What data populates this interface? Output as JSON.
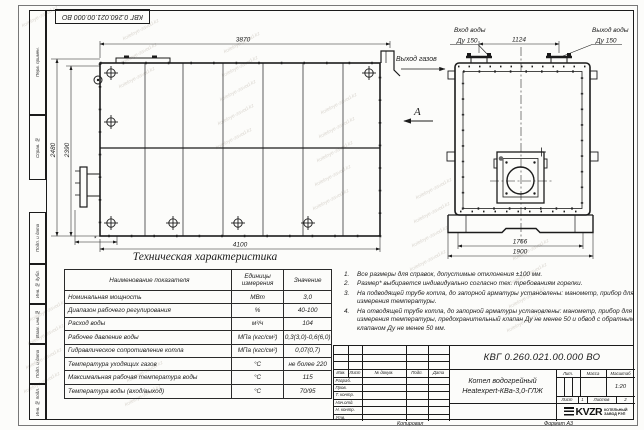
{
  "page": {
    "watermark": "kotelnye-zavod.kz",
    "copied_label": "Копировал",
    "format_label": "Формат А3",
    "doc_number_top": "КВГ 0.260.021.00.000 ВО"
  },
  "frame_columns": [
    "Перв. примен.",
    "Справ. №",
    "Подп. и дата",
    "Инв. № дубл.",
    "Взам. инв. №",
    "Подп. и дата",
    "Инв. № подл."
  ],
  "drawing": {
    "side_view": {
      "dim_top": "3870",
      "dim_left_outer": "2480",
      "dim_left_inner": "2390",
      "dim_bottom": "4100",
      "dim_asterisk": "*",
      "gas_out_label": "Выход газов",
      "view_arrow_label": "А"
    },
    "front_view": {
      "water_in_line1": "Вход воды",
      "water_in_line2": "Ду 150",
      "water_out_line1": "Выход воды",
      "water_out_line2": "Ду 150",
      "dim_nozzles": "1124",
      "dim_width_inner": "1766",
      "dim_width_outer": "1900"
    }
  },
  "spec_table": {
    "title": "Техническая характеристика",
    "col_name": "Наименование показателя",
    "col_units": "Единицы измерения",
    "col_value": "Значение",
    "rows": [
      {
        "name": "Номинальная мощность",
        "units": "МВт",
        "value": "3,0"
      },
      {
        "name": "Диапазон рабочего регулирования",
        "units": "%",
        "value": "40-100"
      },
      {
        "name": "Расход воды",
        "units": "м³/ч",
        "value": "104"
      },
      {
        "name": "Рабочее давление воды",
        "units": "МПа (кгс/см²)",
        "value": "0,3(3,0)-0,6(6,0)"
      },
      {
        "name": "Гидравлическое сопротивление котла",
        "units": "МПа (кгс/см²)",
        "value": "0,07(0,7)"
      },
      {
        "name": "Температура уходящих газов",
        "units": "°С",
        "value": "не более 220"
      },
      {
        "name": "Максимальная рабочая температура воды",
        "units": "°С",
        "value": "115"
      },
      {
        "name": "Температура воды (вход/выход)",
        "units": "°С",
        "value": "70/95"
      }
    ]
  },
  "notes": [
    "Все размеры для справок, допустимые отклонения ±100 мм.",
    "Размер* выбирается индивидуально согласно тех. требованиям горелки.",
    "На подводящей трубе котла, до запорной арматуры установлены: манометр, прибор для измерения температуры.",
    "На отводящей трубе котла, до запорной арматуры установлены: манометр, прибор для измерения температуры, предохранительный клапан Ду не менее 50 и обвод с обратным клапаном Ду не менее 50 мм."
  ],
  "title_block": {
    "doc_number": "КВГ 0.260.021.00.000 ВО",
    "product_line1": "Котел водогрейный",
    "product_line2": "Heatexpert-КВа-3,0-ГЛЖ",
    "rev_headers": [
      "Изм.",
      "Лист",
      "№ докум.",
      "Подп.",
      "Дата"
    ],
    "sign_rows": [
      "Разраб.",
      "Пров.",
      "Т. контр.",
      "Нач.отд.",
      "Н. контр.",
      "Утв."
    ],
    "lit_label": "Лит.",
    "mass_label": "Масса",
    "scale_label": "Масштаб",
    "scale_value": "1:20",
    "sheet_label": "Лист",
    "sheet_value": "1",
    "sheets_label": "Листов",
    "sheets_value": "2",
    "logo_text": "KVZR",
    "logo_sub1": "КОТЕЛЬНЫЙ",
    "logo_sub2": "ЗАВОД РЭП"
  }
}
